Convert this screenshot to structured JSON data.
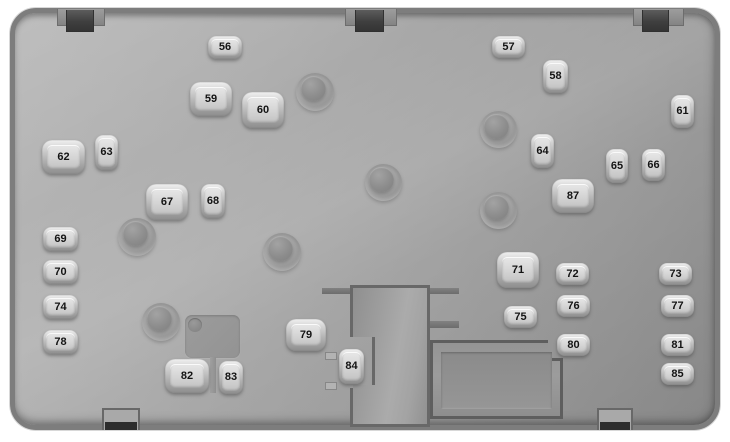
{
  "diagram": {
    "title": "Vehicle fuse box diagram",
    "panel_color": "#a6a6a6",
    "panel_border_color": "#7d7d7d",
    "fuse_face_color": "#d4d4d4",
    "fuse_number_color": "#141414",
    "bolt_post_count": 7,
    "top_mounting_tab_count": 3,
    "bottom_mounting_tab_count": 2
  },
  "fuses": [
    {
      "label": "56"
    },
    {
      "label": "57"
    },
    {
      "label": "58"
    },
    {
      "label": "59"
    },
    {
      "label": "60"
    },
    {
      "label": "61"
    },
    {
      "label": "62"
    },
    {
      "label": "63"
    },
    {
      "label": "64"
    },
    {
      "label": "65"
    },
    {
      "label": "66"
    },
    {
      "label": "67"
    },
    {
      "label": "68"
    },
    {
      "label": "69"
    },
    {
      "label": "70"
    },
    {
      "label": "71"
    },
    {
      "label": "72"
    },
    {
      "label": "73"
    },
    {
      "label": "74"
    },
    {
      "label": "75"
    },
    {
      "label": "76"
    },
    {
      "label": "77"
    },
    {
      "label": "78"
    },
    {
      "label": "79"
    },
    {
      "label": "80"
    },
    {
      "label": "81"
    },
    {
      "label": "82"
    },
    {
      "label": "83"
    },
    {
      "label": "84"
    },
    {
      "label": "85"
    },
    {
      "label": "87"
    }
  ]
}
